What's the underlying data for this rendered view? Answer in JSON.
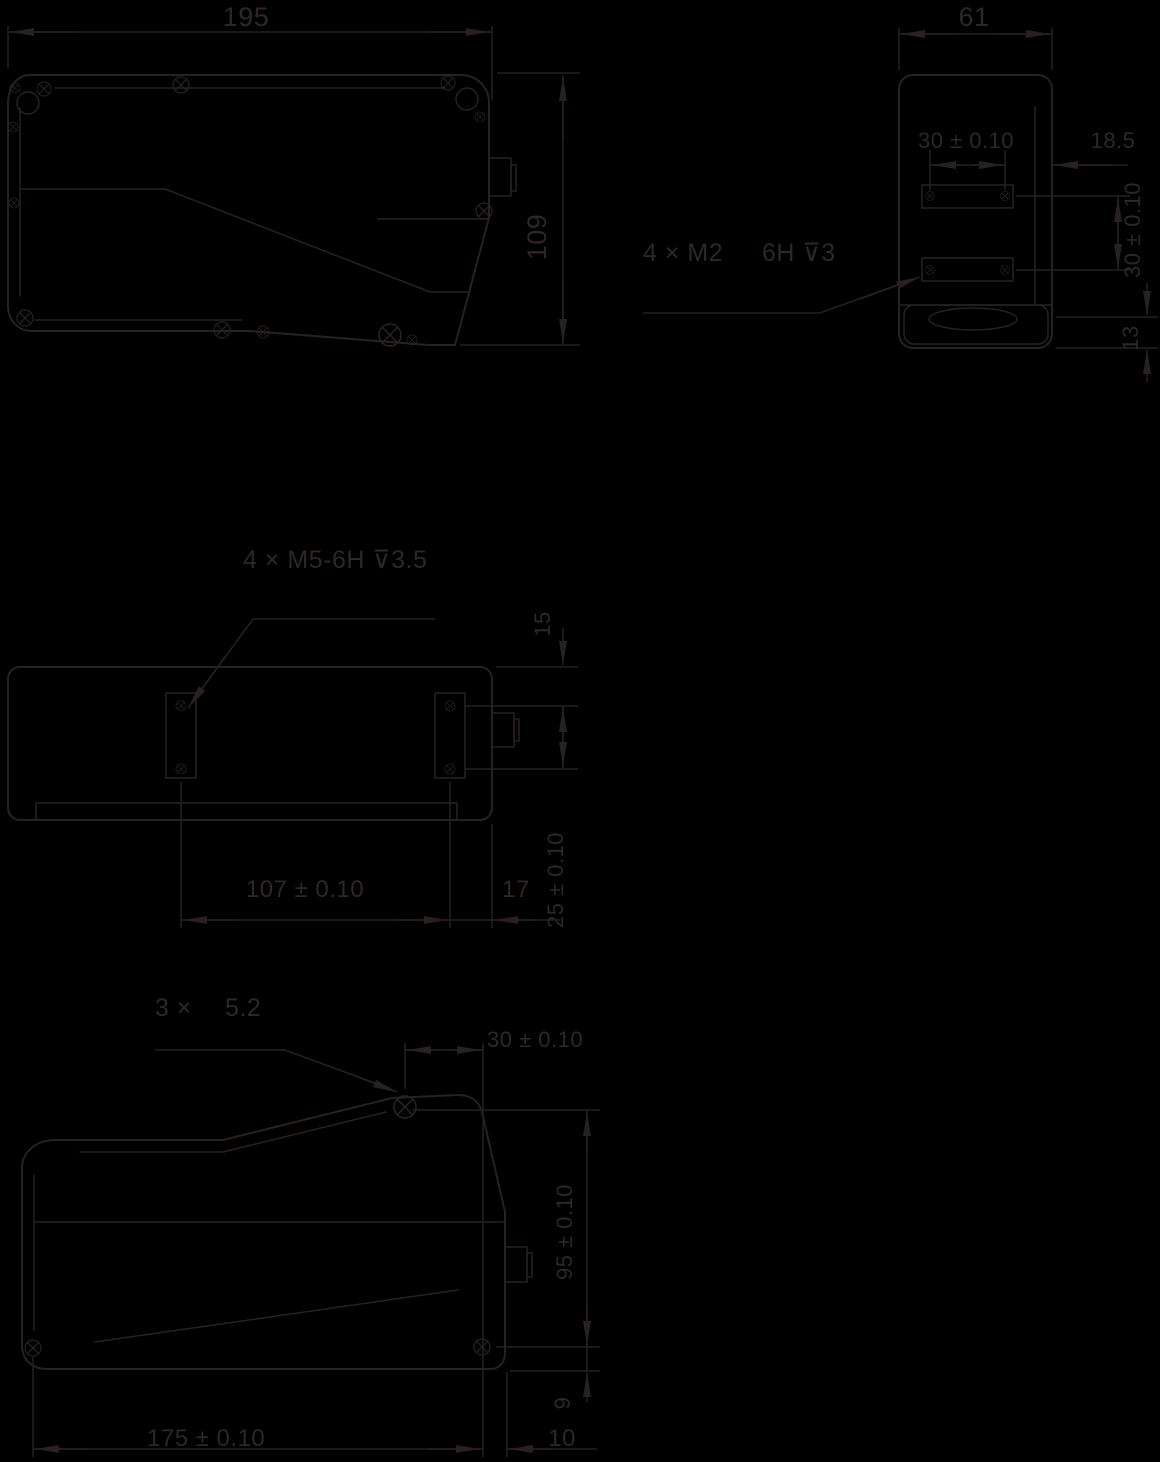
{
  "colors": {
    "background": "#000000",
    "line": "#282023",
    "text": "#2e262a"
  },
  "views": {
    "side_view_top": {
      "width_dim": "195",
      "height_dim": "109"
    },
    "end_view": {
      "width_dim": "61",
      "hole_pitch_horizontal": "30 ± 0.10",
      "edge_offset": "18.5",
      "thread_label_left": "4 × M2",
      "thread_label_right": "6H ⊽3",
      "hole_pitch_vertical": "30 ± 0.10",
      "window_offset": "13"
    },
    "top_view": {
      "thread_label": "4 × M5-6H ⊽3.5",
      "top_offset": "15",
      "hole_pitch_vertical": "25 ± 0.10",
      "hole_pitch_horizontal": "107 ± 0.10",
      "edge_offset": "17"
    },
    "side_view_bottom": {
      "hole_label_prefix": "3 ×",
      "hole_label_value": "5.2",
      "hole_offset": "30 ± 0.10",
      "height_dim": "95 ± 0.10",
      "base_offset": "9",
      "length_dim": "175 ± 0.10",
      "edge_offset": "10"
    }
  }
}
